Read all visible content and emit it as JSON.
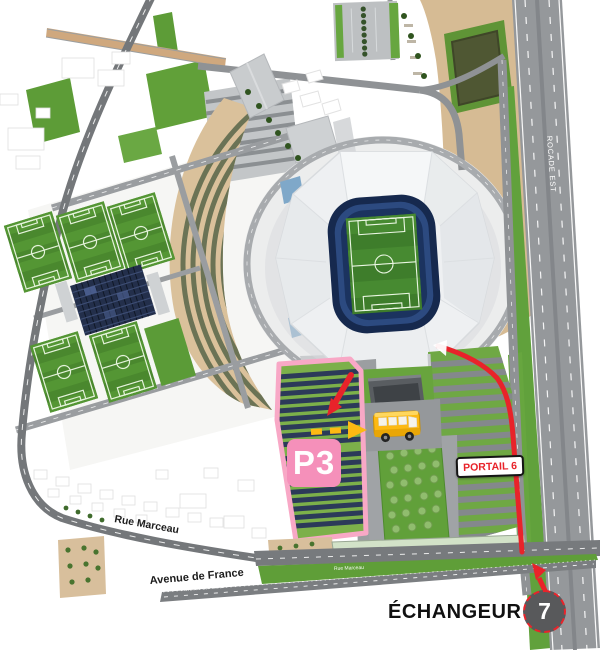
{
  "map": {
    "street_labels": {
      "rue_marceau": "Rue Marceau",
      "avenue_de_france": "Avenue de France",
      "rue_marceau_onroad": "Rue Marceau",
      "avenue_de_france_onroad": "Avenue de France",
      "rocade_est": "ROCADE EST"
    },
    "markers": {
      "parking_label": "P3",
      "portal_label": "PORTAIL 6",
      "interchange_label": "ÉCHANGEUR",
      "interchange_number": "7"
    },
    "colors": {
      "route_red": "#E8232A",
      "parking_outline_pink": "#F8A8C6",
      "parking_badge_pink": "#F590BA",
      "portal_text_red": "#E8232A",
      "shuttle_yellow": "#FDB913",
      "interchange_badge_gray": "#58595B",
      "pitch_green": "#3E7D2B",
      "stadium_bowl_navy": "#16294E"
    }
  }
}
